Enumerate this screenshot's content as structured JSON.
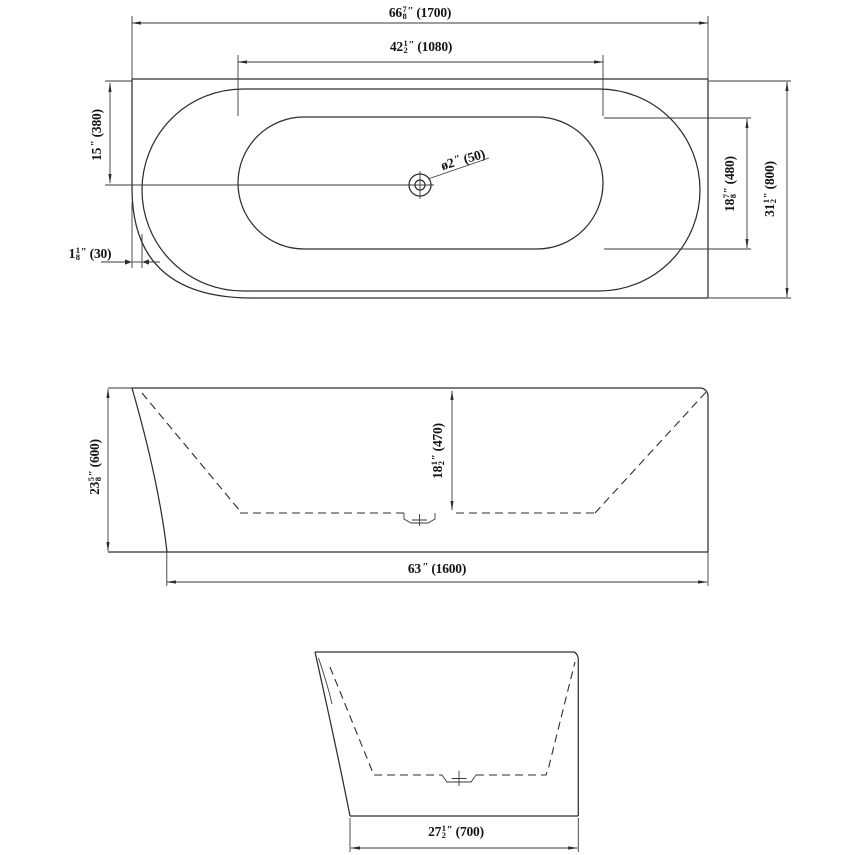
{
  "marks": {
    "inch": "″"
  },
  "colors": {
    "line": "#2e2e2e",
    "text": "#141414",
    "background": "#ffffff"
  },
  "views": {
    "top": {
      "dims": {
        "overall_length": {
          "w": "66",
          "n": "7",
          "d": "8",
          "mm": "(1700)"
        },
        "basin_length": {
          "w": "42",
          "n": "1",
          "d": "2",
          "mm": "(1080)"
        },
        "drain_offset": {
          "w": "15",
          "n": "",
          "d": "",
          "mm": "(380)"
        },
        "edge_gap": {
          "w": "1",
          "n": "1",
          "d": "8",
          "mm": "(30)"
        },
        "drain_diameter": {
          "w": "ø2",
          "n": "",
          "d": "",
          "mm": "(50)"
        },
        "basin_width": {
          "w": "18",
          "n": "7",
          "d": "8",
          "mm": "(480)"
        },
        "overall_width": {
          "w": "31",
          "n": "1",
          "d": "2",
          "mm": "(800)"
        }
      }
    },
    "side": {
      "dims": {
        "overall_height": {
          "w": "23",
          "n": "5",
          "d": "8",
          "mm": "(600)"
        },
        "basin_depth": {
          "w": "18",
          "n": "1",
          "d": "2",
          "mm": "(470)"
        },
        "base_length": {
          "w": "63",
          "n": "",
          "d": "",
          "mm": "(1600)"
        }
      }
    },
    "end": {
      "dims": {
        "base_width": {
          "w": "27",
          "n": "1",
          "d": "2",
          "mm": "(700)"
        }
      }
    }
  }
}
